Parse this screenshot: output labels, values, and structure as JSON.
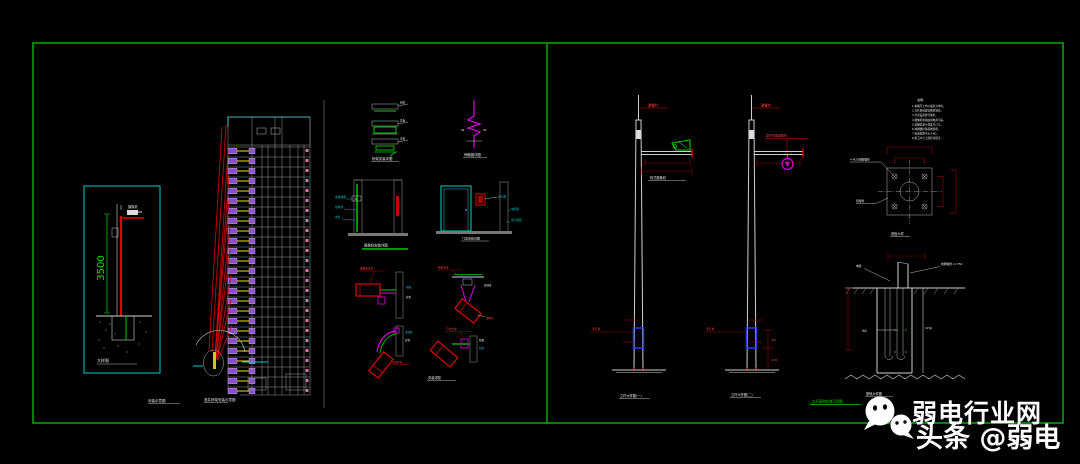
{
  "canvas": {
    "width": 1080,
    "height": 464,
    "background": "#000000",
    "frame_color": "#00a100"
  },
  "left": {
    "inset": {
      "dim": "3500",
      "device_label": "摄像机",
      "caption": "大样图"
    },
    "building": {
      "caption1": "安装示意图",
      "caption2": "竖井桥架安装示意图"
    }
  },
  "middle": {
    "bracket": {
      "l1": "桥架",
      "l2": "盖板",
      "l3": "支架",
      "caption": "桥架安装详图"
    },
    "joint": {
      "l1": "40",
      "l2": "40",
      "caption": "伸缩缝详图"
    },
    "wall": {
      "l1": "金属线槽",
      "l2": "接地线",
      "l3": "支架"
    },
    "door": {
      "l1": "读卡器",
      "l2": "电控锁",
      "l3": "出门按钮",
      "caption": "门禁安装详图"
    },
    "cams": {
      "header": "摄像机安装详图",
      "caption": "安装详图",
      "tl1": "摄像机支架",
      "tl2": "线槽",
      "tl3": "软管",
      "tr1": "吊装支架",
      "tr2": "接线盒",
      "tr3": "摄像机",
      "bl1": "接线盒",
      "bl2": "软管",
      "bl3": "金属软管",
      "br1": "万向支架",
      "br2": "线槽",
      "br3": "软管"
    }
  },
  "right": {
    "pole1": {
      "tip_label": "避雷针",
      "arm_label": "枪式摄像机",
      "lead_label": "手孔井",
      "caption": "立杆大样图(一)"
    },
    "pole2": {
      "tip_label": "避雷针",
      "top_label": "室外球型摄像机",
      "lead_label": "手孔井",
      "dim1": "500",
      "dim2": "1000",
      "caption": "立杆大样图(二)"
    },
    "notes": {
      "header": "说明:",
      "items": [
        "1.本图尺寸均以毫米为单位。",
        "2.立杆采用镀锌钢管制作。",
        "3.杆顶设避雷针保护。",
        "4.摄像机电源由弱电井引来。",
        "5.基础混凝土强度为C25。",
        "6.地脚螺栓随基础预埋。",
        "7.接地电阻不大于4Ω。",
        "8.施工时与土建密切配合。"
      ]
    },
    "plate": {
      "label1": "4-M20地脚螺栓",
      "label2": "预埋件",
      "caption": "底板大样"
    },
    "foundation": {
      "label_cable": "电缆",
      "label_bolt": "地脚螺栓 L=750",
      "label_mid": "垫层",
      "label_conc": "C25砼",
      "caption": "基础大样图"
    },
    "green_caption": "立杆基础安装示意图"
  },
  "watermark": {
    "line1": "弱电行业网",
    "line2": "头条 @弱电"
  }
}
